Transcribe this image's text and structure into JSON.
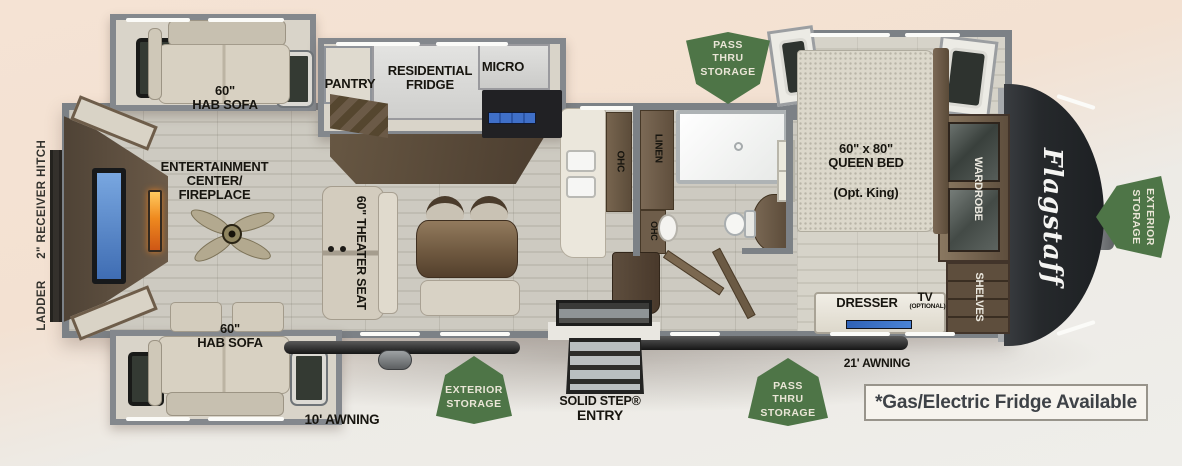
{
  "title": "Flagstaff fifth wheel floor plan",
  "brand_logo": "Flagstaff",
  "footnote": "*Gas/Electric Fridge Available",
  "exterior": {
    "ladder_hitch": "LADDER      2\" RECEIVER HITCH",
    "awning_front": "21' AWNING",
    "awning_rear": "10' AWNING",
    "entry_line1": "SOLID STEP®",
    "entry_line2": "ENTRY"
  },
  "badges": {
    "pass_thru_top": [
      "PASS",
      "THRU",
      "STORAGE"
    ],
    "pass_thru_bottom": [
      "PASS",
      "THRU",
      "STORAGE"
    ],
    "exterior_bottom": [
      "EXTERIOR",
      "STORAGE"
    ],
    "exterior_right": [
      "EXTERIOR",
      "STORAGE"
    ]
  },
  "labels": {
    "sofa_top": [
      "60\"",
      "HAB SOFA"
    ],
    "sofa_bottom": [
      "60\"",
      "HAB SOFA"
    ],
    "entertainment": [
      "ENTERTAINMENT",
      "CENTER/",
      "FIREPLACE"
    ],
    "pantry": "PANTRY",
    "fridge": [
      "RESIDENTIAL",
      "FRIDGE"
    ],
    "micro": "MICRO",
    "theater_seat": "60\" THEATER SEAT",
    "ohc_island": "OHC",
    "ohc_hall": "OHC",
    "linen": "LINEN",
    "bed_size": [
      "60\" x 80\"",
      "QUEEN BED"
    ],
    "bed_option": "(Opt. King)",
    "wardrobe": "WARDROBE",
    "shelves": "SHELVES",
    "dresser": "DRESSER",
    "tv": "TV",
    "tv_option": "(OPTIONAL)"
  },
  "colors": {
    "badge_green": "#4e7547",
    "fireplace_orange": "#e8821e",
    "tv_blue": "#4a7fd0",
    "front_cap": "#232629"
  }
}
